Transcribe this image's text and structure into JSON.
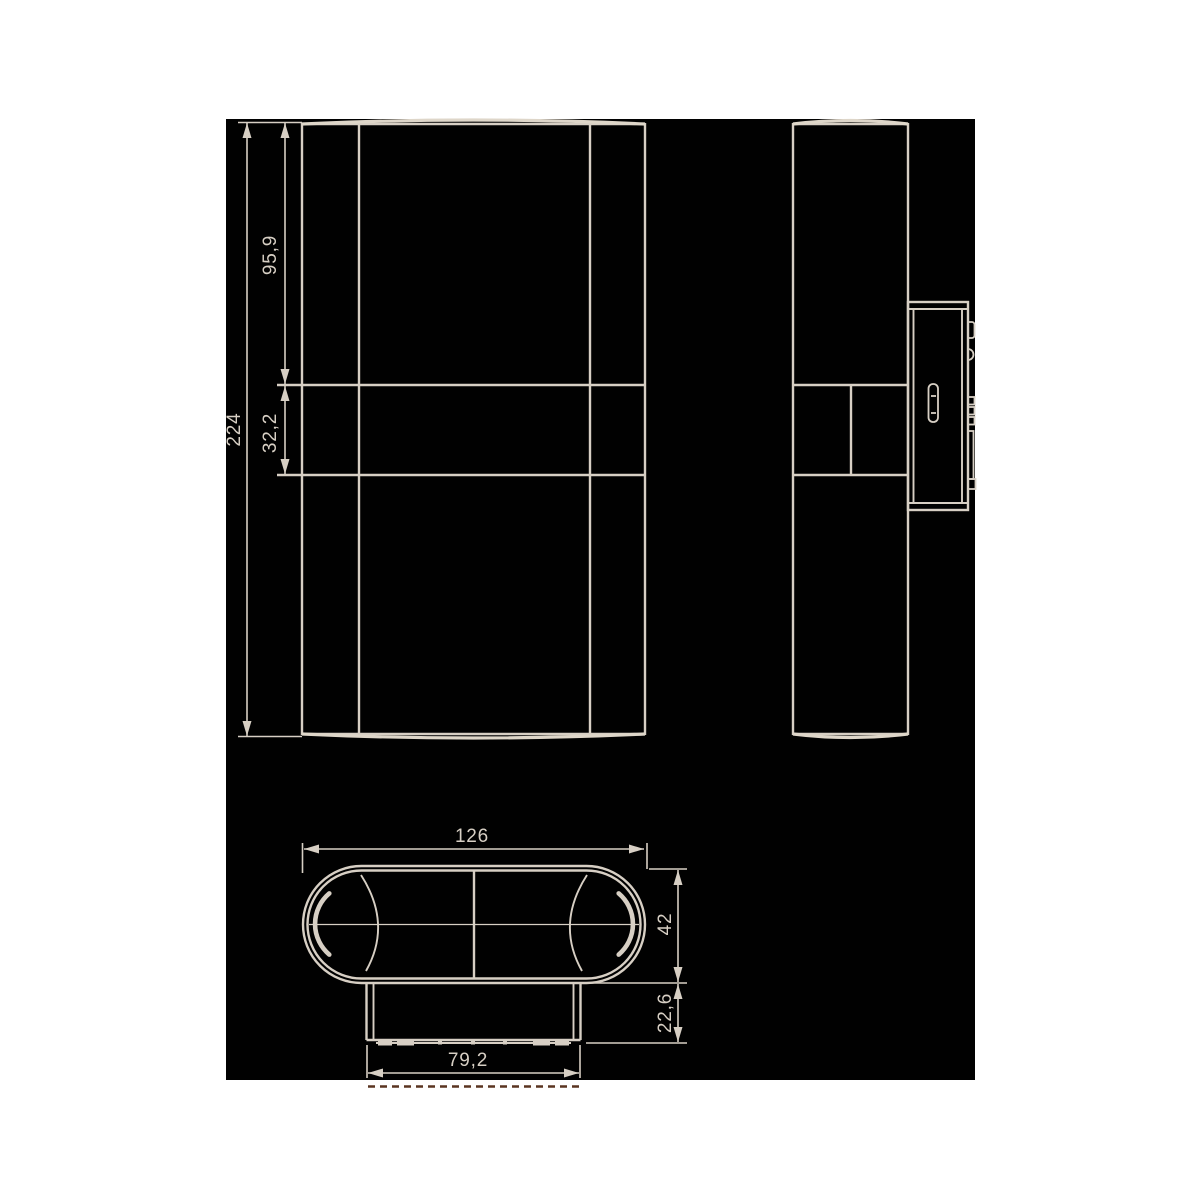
{
  "canvas": {
    "page_background": "#ffffff",
    "background": "#010101",
    "line_color": "#d7cfc4",
    "highlight_line_color": "#ded6c9",
    "dashed_accent_color": "#5a3420"
  },
  "dimensions": {
    "overall_height": {
      "label": "224"
    },
    "upper_section_height": {
      "label": "95,9"
    },
    "middle_section_height": {
      "label": "32,2"
    },
    "overall_width": {
      "label": "126"
    },
    "depth": {
      "label": "42"
    },
    "mounting_plate_depth": {
      "label": "22,6"
    },
    "mounting_plate_width": {
      "label": "79,2"
    }
  }
}
